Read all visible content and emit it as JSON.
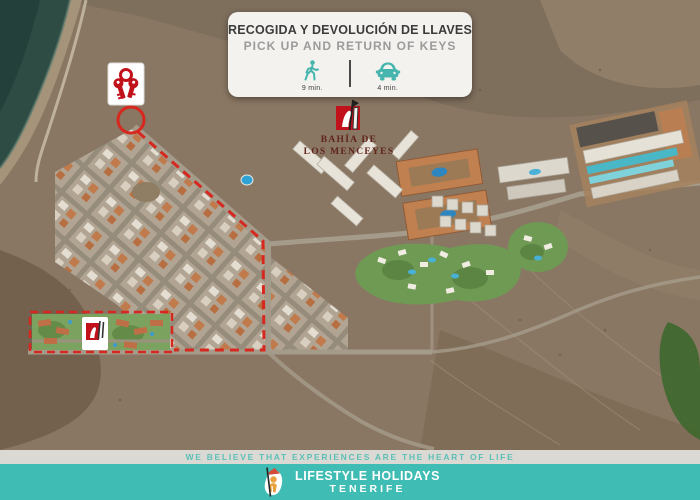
{
  "colors": {
    "teal_accent": "#45b5ad",
    "teal_band": "#3fbcb3",
    "brand_red": "#c1121c",
    "route_red": "#d6281e",
    "maroon_text": "#5f241c",
    "card_bg": "#f3f2ef",
    "tagline_bar_bg": "#dbd9d4",
    "title_dark": "#3b3b3b",
    "subtitle_gray": "#9b9b9b"
  },
  "top_card": {
    "title": "RECOGIDA Y DEVOLUCIÓN DE LLAVES",
    "subtitle": "PICK UP AND RETURN OF KEYS",
    "walk": {
      "icon": "walking-icon",
      "time": "9 min."
    },
    "drive": {
      "icon": "car-icon",
      "time": "4 min."
    }
  },
  "map": {
    "property_logo": {
      "line1": "BAHÍA DE",
      "line2": "LOS MENCEYES"
    },
    "markers": {
      "keys_marker": "keys-icon white card marking key pick-up office",
      "pickup_circle": "red circle around pick-up point",
      "route": "red dashed route from pick-up point to property",
      "property_area": "red dashed rectangle around Bahía de los Menceyes resort"
    }
  },
  "footer": {
    "tagline": "WE BELIEVE THAT EXPERIENCES ARE THE HEART OF LIFE",
    "brand_line1": "LIFESTYLE HOLIDAYS",
    "brand_line2": "TENERIFE"
  }
}
